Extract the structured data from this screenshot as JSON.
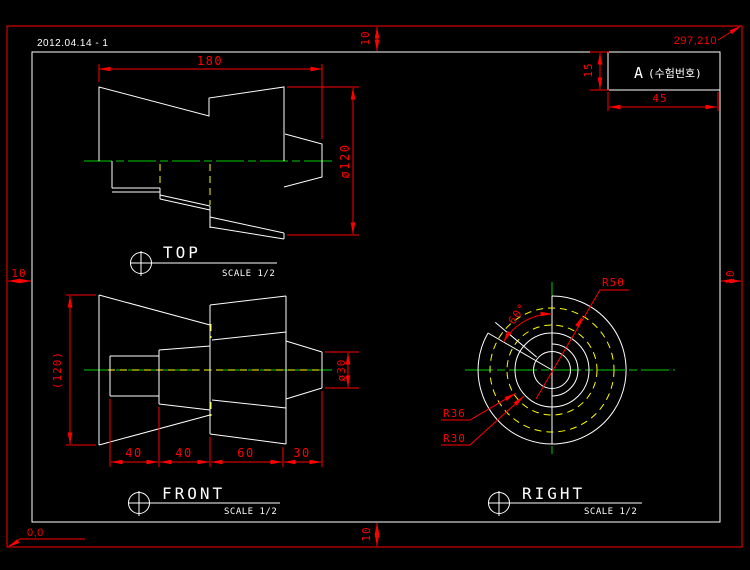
{
  "meta": {
    "date": "2012.04.14 - 1",
    "paper_size": "297,210",
    "origin": "0,0"
  },
  "colors": {
    "background": "#000000",
    "outer_border": "#ff0000",
    "inner_border": "#ffffff",
    "geometry": "#ffffff",
    "dimension": "#ff0000",
    "centerline": "#00cc00",
    "hidden_line": "#ffff00"
  },
  "margins": {
    "top": "10",
    "left": "10",
    "right": "10",
    "bottom": "10"
  },
  "title_block": {
    "grade": "A",
    "exam_label": "(수험번호)",
    "height": "15",
    "width": "45"
  },
  "views": {
    "top": {
      "label": "TOP",
      "scale": "SCALE 1/2",
      "dim_length": "180",
      "dim_diameter": "ø120"
    },
    "front": {
      "label": "FRONT",
      "scale": "SCALE 1/2",
      "dim_height": "(120)",
      "dim_tip_diameter": "ø30",
      "dim_seg1": "40",
      "dim_seg2": "40",
      "dim_seg3": "60",
      "dim_seg4": "30"
    },
    "right": {
      "label": "RIGHT",
      "scale": "SCALE 1/2",
      "dim_outer_radius": "R50",
      "dim_mid_radius": "R36",
      "dim_inner_radius": "R30",
      "dim_angle": "60°"
    }
  }
}
